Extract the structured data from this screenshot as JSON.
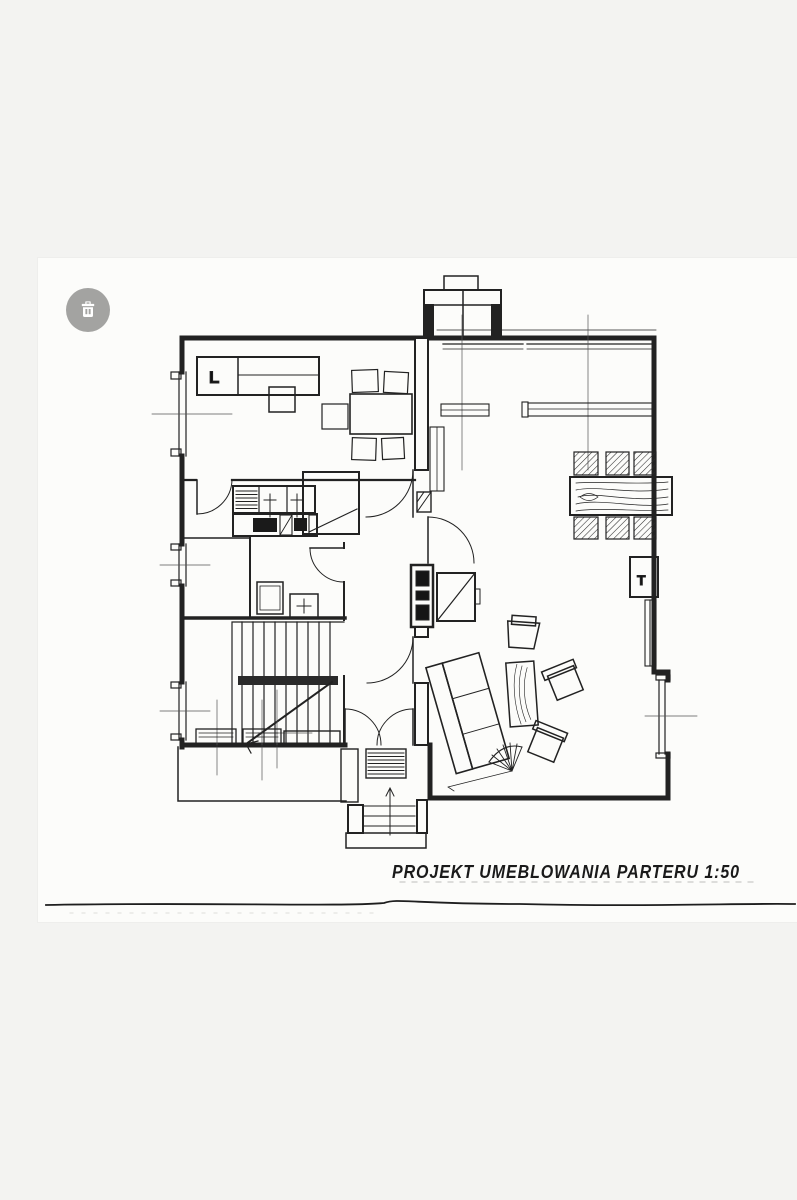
{
  "page": {
    "background": "#f3f3f1",
    "paper_color": "#fcfcfa",
    "ink_color": "#222222"
  },
  "toolbar": {
    "delete_button_icon": "trash-icon",
    "delete_button_color": "#a3a3a1"
  },
  "plan": {
    "title": "PROJEKT UMEBLOWANIA PARTERU 1:50",
    "labels": {
      "bed": "L",
      "tv": "T"
    }
  }
}
